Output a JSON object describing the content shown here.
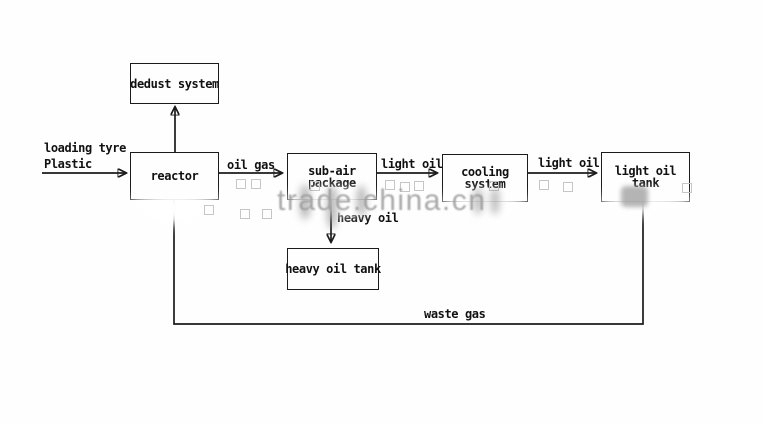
{
  "diagram_title": "tyre plastic pyrolysis process flow",
  "nodes": {
    "dedust": {
      "label": "dedust system"
    },
    "reactor": {
      "label": "reactor"
    },
    "subair": {
      "line1": "sub-air",
      "line2": "package"
    },
    "cooling": {
      "line1": "cooling",
      "line2": "system"
    },
    "light_tank": {
      "line1": "light oil",
      "line2": "tank"
    },
    "heavy_tank": {
      "label": "heavy oil tank"
    }
  },
  "flows": {
    "feed_line1": "loading tyre",
    "feed_line2": "Plastic",
    "oil_gas": "oil gas",
    "light_oil_a": "light oil",
    "light_oil_b": "light oil",
    "heavy_oil": "heavy oil",
    "waste_gas": "waste gas"
  },
  "watermark": {
    "text": "trade.china.cn"
  },
  "colors": {
    "background": "#fefefe",
    "line": "#1b1b1b",
    "text": "#111111",
    "watermark": "#9b9b9b"
  }
}
